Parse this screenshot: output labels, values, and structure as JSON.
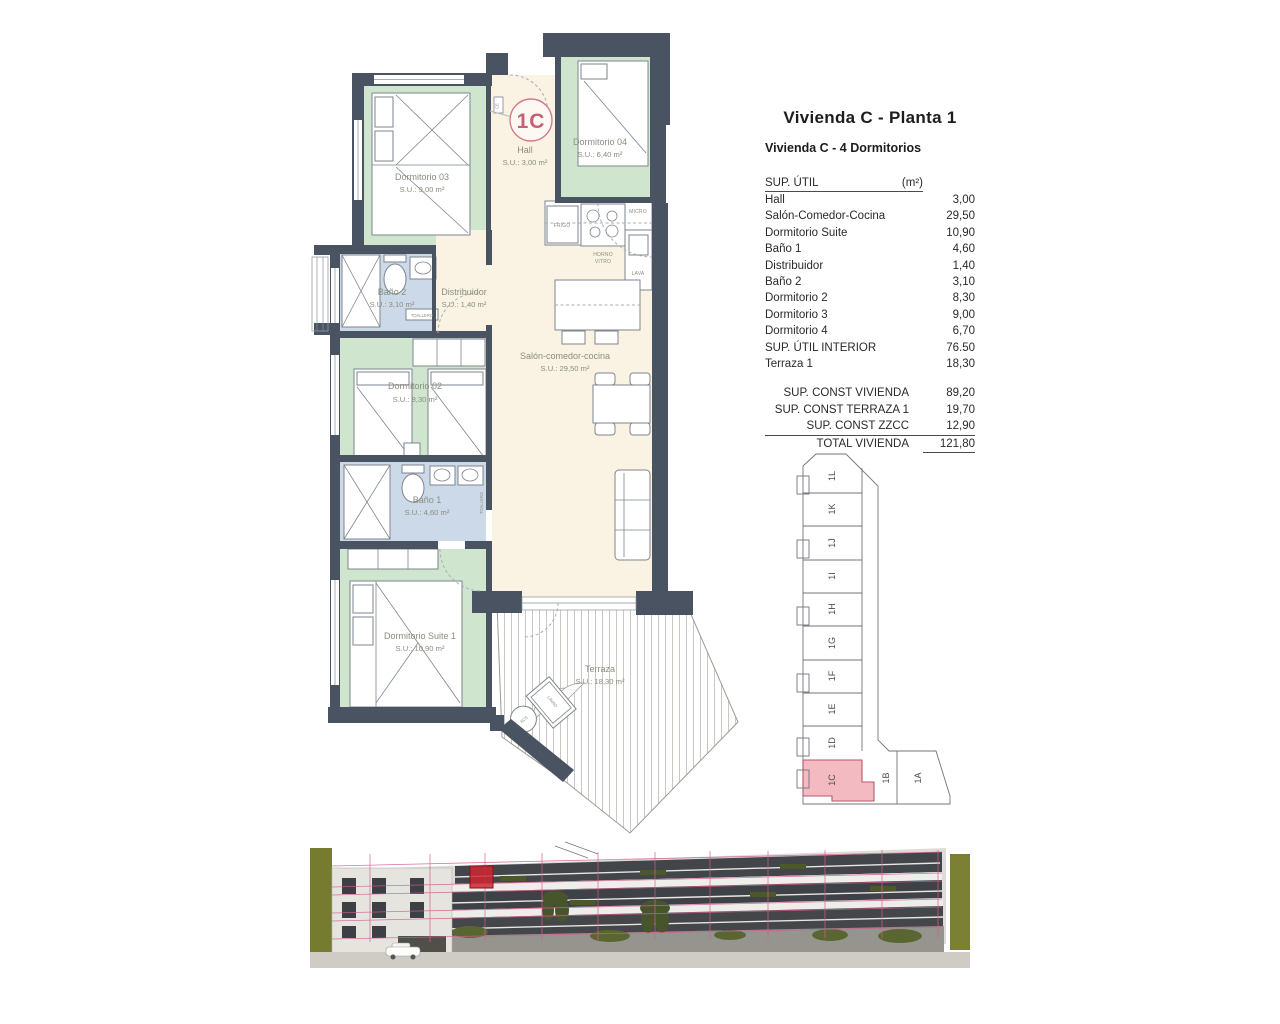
{
  "header": {
    "title": "Vivienda C - Planta 1",
    "subtitle": "Vivienda C - 4 Dormitorios"
  },
  "area_table": {
    "header_label": "SUP. ÚTIL",
    "header_unit": "(m²)",
    "rows": [
      {
        "label": "Hall",
        "value": "3,00"
      },
      {
        "label": "Salón-Comedor-Cocina",
        "value": "29,50"
      },
      {
        "label": "Dormitorio Suite",
        "value": "10,90"
      },
      {
        "label": "Baño 1",
        "value": "4,60"
      },
      {
        "label": "Distribuidor",
        "value": "1,40"
      },
      {
        "label": "Baño 2",
        "value": "3,10"
      },
      {
        "label": "Dormitorio 2",
        "value": "8,30"
      },
      {
        "label": "Dormitorio 3",
        "value": "9,00"
      },
      {
        "label": "Dormitorio 4",
        "value": "6,70"
      },
      {
        "label": "SUP. ÚTIL INTERIOR",
        "value": "76.50"
      },
      {
        "label": "Terraza 1",
        "value": "18,30"
      }
    ],
    "summary": [
      {
        "label": "SUP. CONST VIVIENDA",
        "value": "89,20"
      },
      {
        "label": "SUP. CONST TERRAZA 1",
        "value": "19,70"
      },
      {
        "label": "SUP. CONST ZZCC",
        "value": "12,90"
      },
      {
        "label": "TOTAL VIVIENDA",
        "value": "121,80"
      }
    ]
  },
  "floor_plan": {
    "unit_badge": "1C",
    "rooms": [
      {
        "name": "Dormitorio 03",
        "area": "S.U.: 9,00 m²"
      },
      {
        "name": "Hall",
        "area": "S.U.: 3,00 m²"
      },
      {
        "name": "Dormitorio 04",
        "area": "S.U.: 6,40 m²"
      },
      {
        "name": "Baño 2",
        "area": "S.U.: 3,10 m²"
      },
      {
        "name": "Distribuidor",
        "area": "S.U.: 1,40 m²"
      },
      {
        "name": "Dormitorio 02",
        "area": "S.U.: 8,30 m²"
      },
      {
        "name": "Salón-comedor-cocina",
        "area": "S.U.: 29,50 m²"
      },
      {
        "name": "Baño 1",
        "area": "S.U.: 4,60 m²"
      },
      {
        "name": "Dormitorio Suite 1",
        "area": "S.U.: 10,90 m²"
      },
      {
        "name": "Terraza",
        "area": "S.U.: 18,30 m²"
      }
    ],
    "fixtures": {
      "frigo": "FRIGO",
      "micro": "MICRO",
      "horno_1": "HORNO",
      "horno_2": "VITRO",
      "lava": "LAVA",
      "toallero": "TOALLERO",
      "acs": "ACS",
      "lavad": "LAVAD",
      "ce": "CE"
    }
  },
  "key_plan": {
    "units": [
      "1L",
      "1K",
      "1J",
      "1I",
      "1H",
      "1G",
      "1F",
      "1E",
      "1D",
      "1C",
      "1B",
      "1A"
    ],
    "highlighted_unit": "1C"
  },
  "colors": {
    "wall": "#4a5361",
    "room_green": "#cfe5cd",
    "room_blue": "#ccd9e9",
    "room_cream": "#faf3e3",
    "accent_pink": "#c4607a",
    "keyplan_highlight": "#f3bac1",
    "overlay_pink": "#d06090",
    "highlight_red": "#cd2630",
    "vegetation_olive": "#767b2f"
  }
}
